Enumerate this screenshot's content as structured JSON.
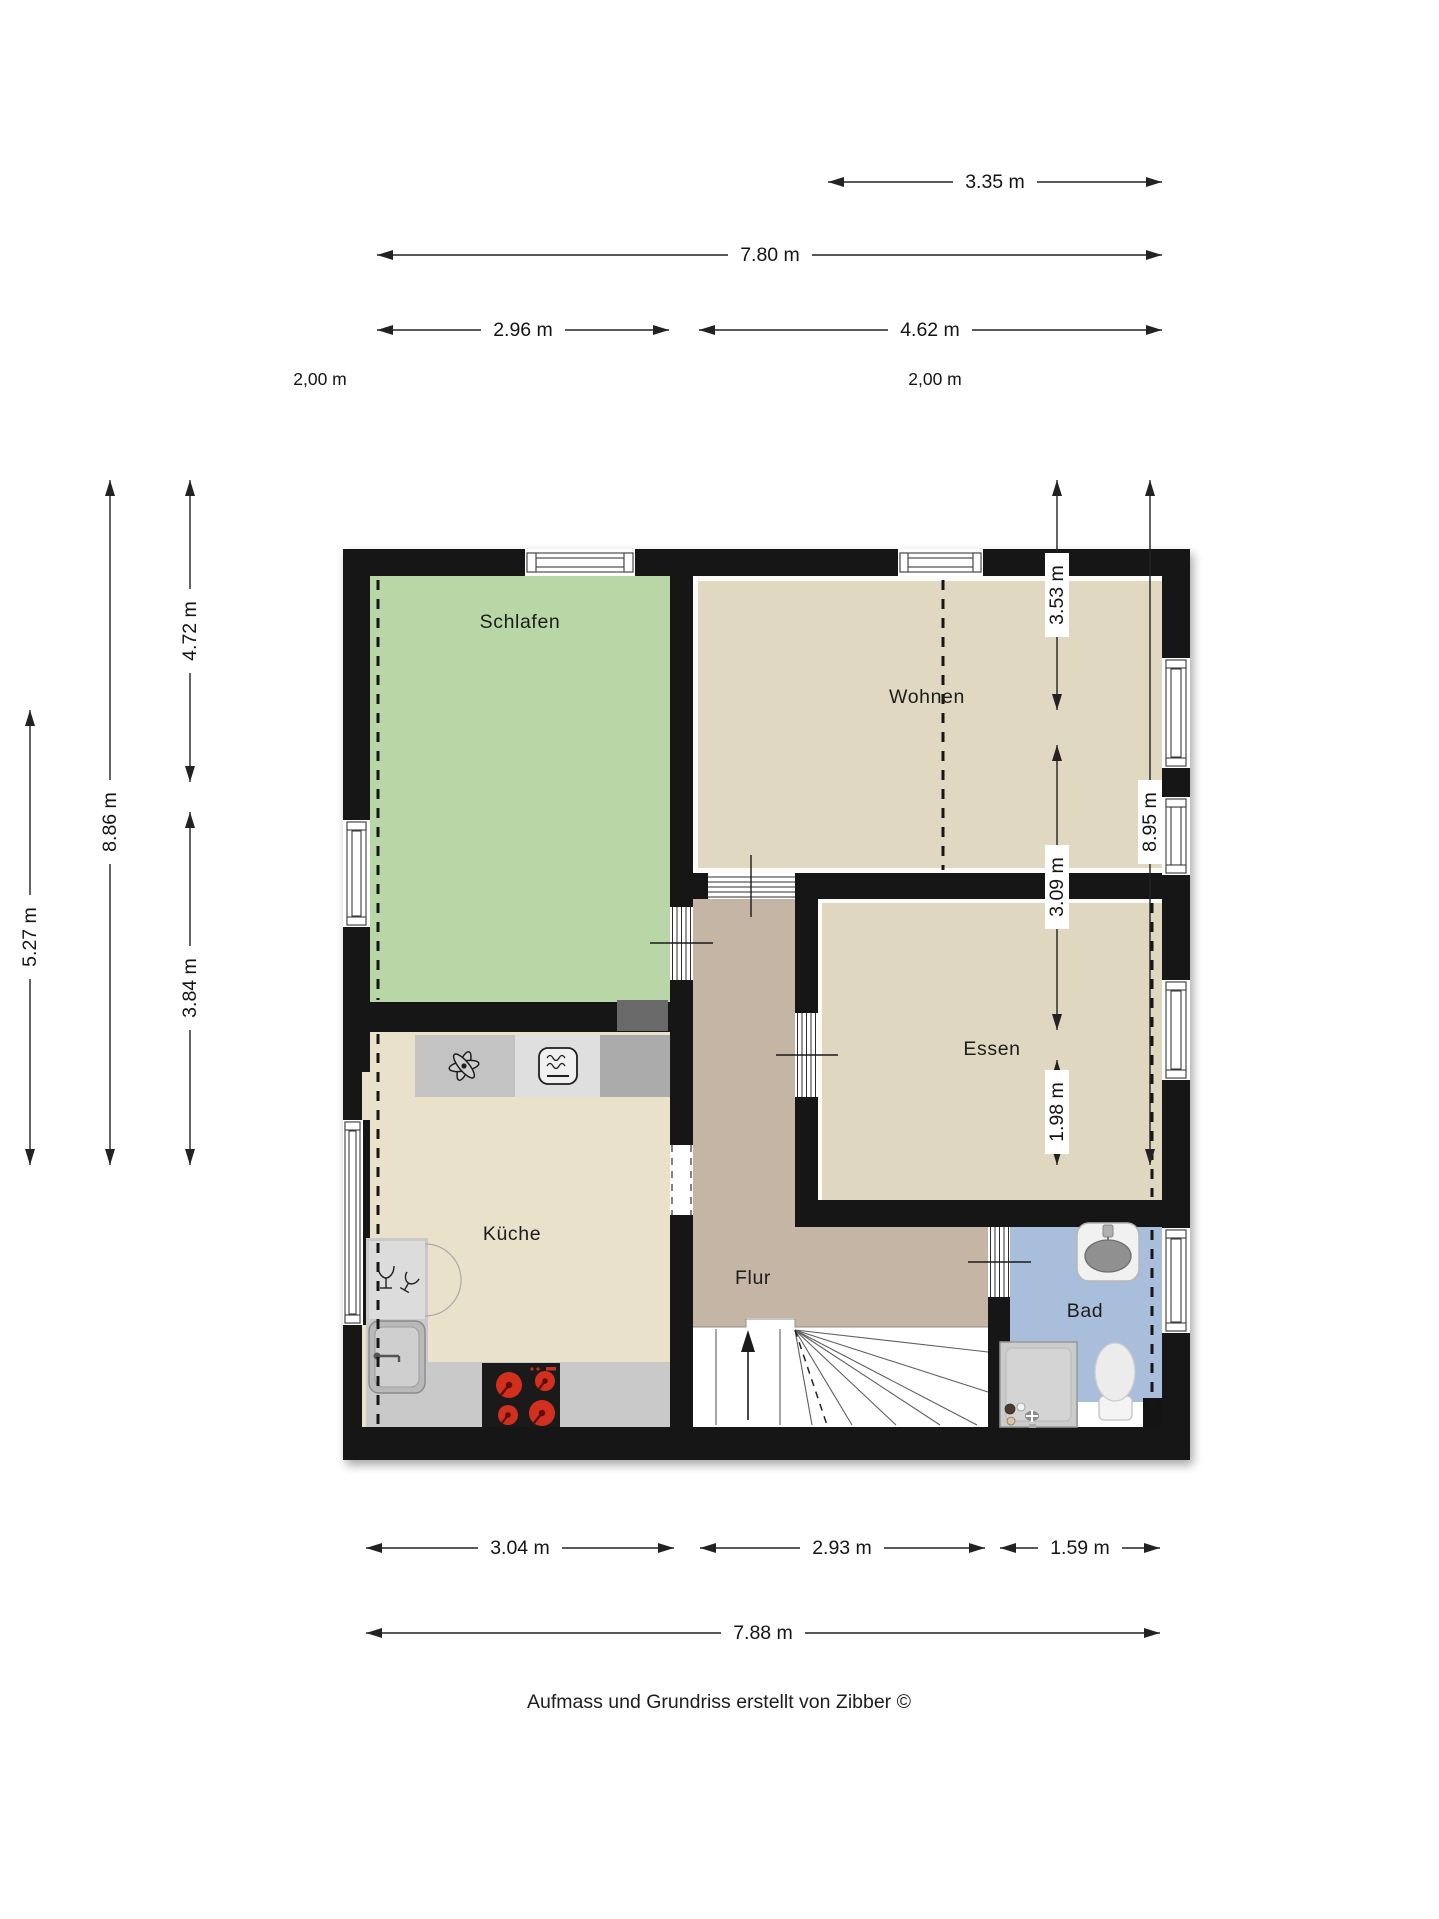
{
  "page": {
    "background": "#ffffff",
    "footer": "Aufmass und Grundriss erstellt von Zibber ©"
  },
  "floorplan": {
    "rooms": {
      "schlafen": {
        "label": "Schlafen"
      },
      "wohnen": {
        "label": "Wohnen"
      },
      "kueche": {
        "label": "Küche"
      },
      "essen": {
        "label": "Essen"
      },
      "flur": {
        "label": "Flur"
      },
      "bad": {
        "label": "Bad"
      }
    },
    "dimensions": {
      "top": [
        {
          "label": "3.35 m"
        },
        {
          "label": "7.80 m"
        },
        {
          "label": "2.96 m"
        },
        {
          "label": "4.62 m"
        }
      ],
      "bottom": [
        {
          "label": "3.04 m"
        },
        {
          "label": "2.93 m"
        },
        {
          "label": "1.59 m"
        },
        {
          "label": "7.88 m"
        }
      ],
      "left": [
        {
          "label": "5.27 m"
        },
        {
          "label": "8.86 m"
        },
        {
          "label": "4.72 m"
        },
        {
          "label": "3.84 m"
        }
      ],
      "right": [
        {
          "label": "3.53 m"
        },
        {
          "label": "8.95 m"
        },
        {
          "label": "3.09 m"
        },
        {
          "label": "1.98 m"
        }
      ]
    },
    "height_markers": {
      "left": "2,00 m",
      "right": "2,00 m"
    },
    "colors": {
      "wall": "#141414",
      "schlafen": "#b9d7a6",
      "wohnen": "#e1d8c2",
      "essen": "#e0d7c1",
      "kueche": "#e9e1ca",
      "flur": "#c4b5a4",
      "bad": "#a9bedb",
      "counter": "#c9c9c9",
      "shaft": "#696969",
      "stairs": "#ffffff",
      "burner": "#d2301f",
      "dimension": "#222222"
    }
  }
}
